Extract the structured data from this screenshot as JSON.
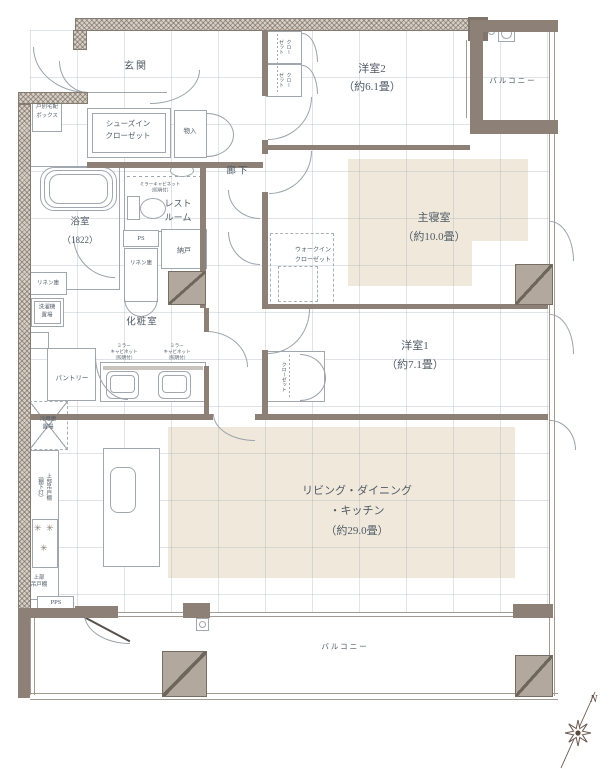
{
  "labels": {
    "genkan": "玄関",
    "delivery_box": "戸別宅配\nボックス",
    "sic": "シューズイン\nクローゼット",
    "mono_genkan": "物入",
    "closet_a": "クロー\nゼット",
    "closet_b": "クロー\nゼット",
    "yoshitsu2_name": "洋室2",
    "yoshitsu2_size": "（約6.1畳）",
    "balcony_upper": "バルコニー",
    "rouka": "廊下",
    "restroom": "レスト\nルーム",
    "mirror_cab_rest": "ミラーキャビネット\n（照明付）",
    "yokushitsu_name": "浴室",
    "yokushitsu_size": "（1822）",
    "ps1": "PS",
    "ps2": "PS",
    "pps": "PPS",
    "nando": "納戸",
    "linen_tall": "リネン庫",
    "linen_small": "リネン庫",
    "laundry": "洗濯機\n置場",
    "keshoshitsu": "化粧室",
    "mirror_cab1": "ミラー\nキャビネット\n（照明付）",
    "mirror_cab2": "ミラー\nキャビネット\n（照明付）",
    "shinshitsu_name": "主寝室",
    "shinshitsu_size": "（約10.0畳）",
    "wic": "ウォークイン\nクローゼット",
    "yoshitsu1_name": "洋室1",
    "yoshitsu1_size": "（約7.1畳）",
    "closet_y1": "クローゼット",
    "pantry": "パントリー",
    "fridge": "冷蔵庫\n置場",
    "hanging_cabinet": "上部吊戸棚\n（棚下灯）",
    "hanging_cabinet2": "上部\n吊戸棚",
    "ldk_line1": "リビング・ダイニング",
    "ldk_line2": "・キッチン",
    "ldk_line3": "（約29.0畳）",
    "balcony_lower": "バルコニー",
    "north": "N"
  },
  "icons": {
    "burner": "✳"
  },
  "colors": {
    "wall": "#8d8177",
    "hatch_wall": "#d6cfc6",
    "room_highlight": "#f0e9db",
    "line": "#a0a7ae",
    "text": "#4f5a66"
  }
}
